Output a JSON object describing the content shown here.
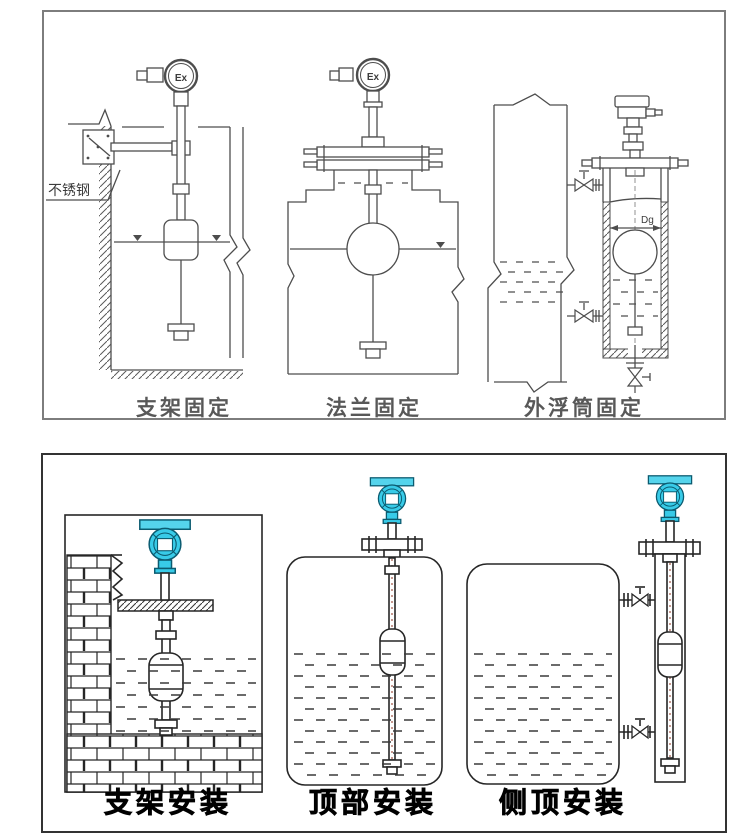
{
  "colors": {
    "accent_teal": "#38cbe8",
    "accent_teal_dark": "#0b5b70",
    "top_panel_border": "#7d7d7d",
    "bottom_panel_border": "#333333",
    "top_line_color": "#4d4d4d",
    "bottom_line_color": "#262626",
    "top_label_color": "#585858",
    "bottom_label_color": "#000000"
  },
  "top_panel": {
    "diagrams": [
      {
        "label": "支架固定",
        "head_label": "Ex",
        "annotation": "不锈钢"
      },
      {
        "label": "法兰固定",
        "head_label": "Ex"
      },
      {
        "label": "外浮筒固定",
        "dim_label": "Dg"
      }
    ]
  },
  "bottom_panel": {
    "diagrams": [
      {
        "label": "支架安装"
      },
      {
        "label": "顶部安装"
      },
      {
        "label": "侧顶安装"
      }
    ]
  }
}
